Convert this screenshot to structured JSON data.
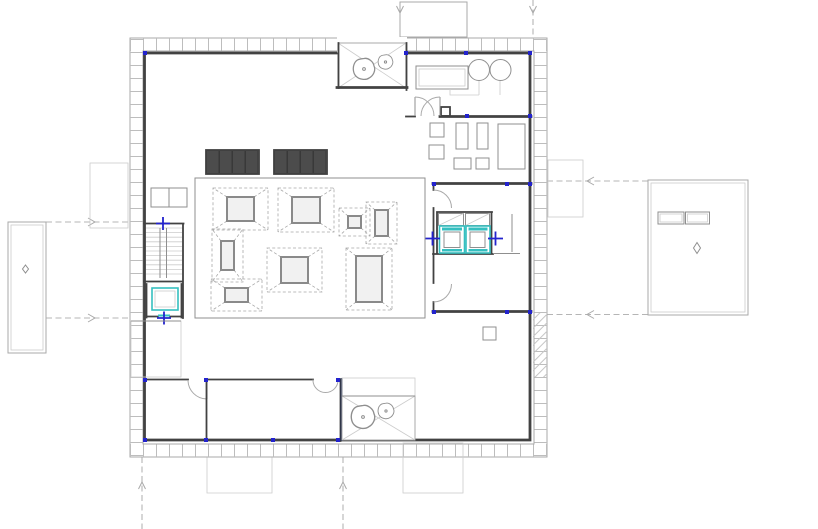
{
  "canvas": {
    "width": 818,
    "height": 529
  },
  "colors": {
    "wall-dark": "#424242",
    "line-med": "#8f8f8f",
    "line-light": "#a9a9a9",
    "line-faint": "#cccccc",
    "masonry": "#bdbdbd",
    "plank": "#d4d4d4",
    "hatch": "#c6c6c6",
    "stipple": "#9c9c9c",
    "ref": "#b5b5b5",
    "fixture-cyan": "#35bfc0",
    "marker-blue": "#2323cd",
    "panel-dark": "#4c4c4c",
    "glazing-navy": "#26304d",
    "sky-fill": "#f1f1f1",
    "sky-edge": "#8a8a8a",
    "paper": "#ffffff"
  },
  "drawing": {
    "kind": "architectural-floor-plan",
    "visible_text": [],
    "elements": {
      "masonry_perimeter_walls": 1,
      "roof_deck_with_planks": 1,
      "skylights": 8,
      "dark_roof_panels": 8,
      "stair": 1,
      "elevator_lift": 1,
      "washing_machines": 2,
      "kitchen_counter": 1,
      "kitchen_sink_circles": 2,
      "courtyards_with_trees": 2,
      "trees": 4,
      "gravel_gardens": 2,
      "garden_benches": 2,
      "plant_diamond_symbols": 2,
      "door_swings": 7,
      "blue_wall_dots": 19,
      "blue_registration_crosses": 4,
      "hatched_voids": 5,
      "dashed_reference_lines": 8,
      "canopy_outlines": 3
    }
  }
}
